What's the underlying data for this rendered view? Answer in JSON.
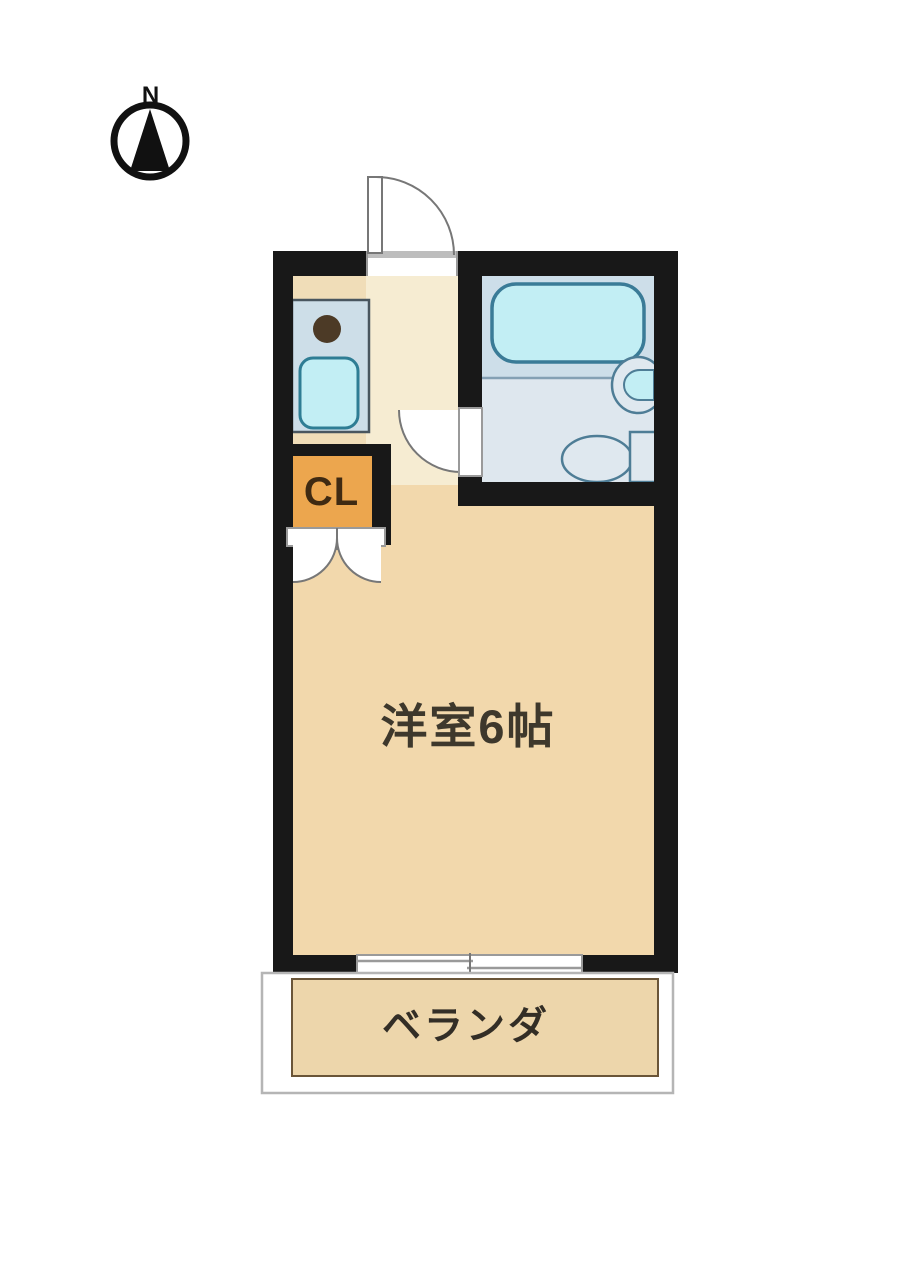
{
  "compass": {
    "label": "N"
  },
  "rooms": {
    "closet": {
      "label": "CL"
    },
    "main_room": {
      "label": "洋室6帖"
    },
    "balcony": {
      "label": "ベランダ"
    }
  },
  "colors": {
    "wall": "#181818",
    "floor_main": "#f2d8ac",
    "floor_kitchen": "#f0ddb8",
    "floor_hall": "#f6ecd2",
    "bath_floor_upper": "#cddee9",
    "bath_floor_lower": "#dee7ee",
    "bath_divider": "#84a0b4",
    "fixture_cyan": "#c2eef4",
    "tub_border": "#3a7b97",
    "sink_border": "#2e7d94",
    "counter_fill": "#cddee8",
    "counter_border": "#49565f",
    "burner": "#4c3a26",
    "porcelain": "#dfe8ef",
    "porcelain_border": "#4e7d96",
    "closet_orange": "#eca64e",
    "balcony_fill": "#edd6ab",
    "balcony_border": "#6a5538",
    "balcony_outer_border": "#b5b5b5",
    "door_line": "#777777",
    "opening_line": "#9a9a9a",
    "white": "#ffffff",
    "ink": "#111111"
  }
}
